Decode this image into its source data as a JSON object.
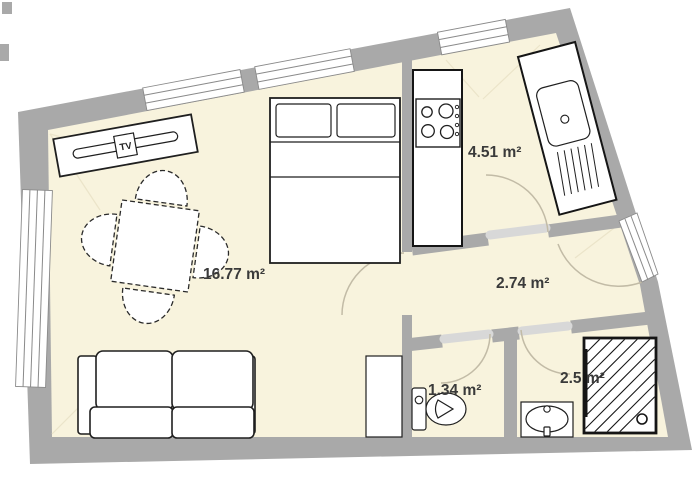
{
  "plan": {
    "type": "apartment-floor-plan",
    "colors": {
      "wall": "#a9a9a9",
      "floor": "#f8f3dd",
      "outline": "#1f1f1f",
      "threshold": "#d8d8d8",
      "door_arc": "#c2bba6",
      "label": "#3a3a3a",
      "background": "#ffffff"
    },
    "rooms": [
      {
        "id": "living-room",
        "area_label": "16.77 m²"
      },
      {
        "id": "kitchen",
        "area_label": "4.51 m²"
      },
      {
        "id": "hallway",
        "area_label": "2.74 m²"
      },
      {
        "id": "wc",
        "area_label": "1.34 m²"
      },
      {
        "id": "bathroom",
        "area_label": "2.5 m²"
      }
    ],
    "furniture": {
      "tv_label": "TV",
      "items": [
        "tv-sideboard",
        "dining-table",
        "dining-chairs",
        "double-bed",
        "sofa",
        "wardrobe",
        "kitchen-counter-stove",
        "kitchen-counter-sink",
        "toilet",
        "washbasin",
        "shower"
      ]
    },
    "openings": {
      "windows": [
        "top-window-1",
        "top-window-2",
        "top-window-3",
        "left-window"
      ],
      "doors": [
        "entry-door",
        "living-room-door",
        "kitchen-door",
        "wc-door",
        "bathroom-door"
      ]
    }
  }
}
